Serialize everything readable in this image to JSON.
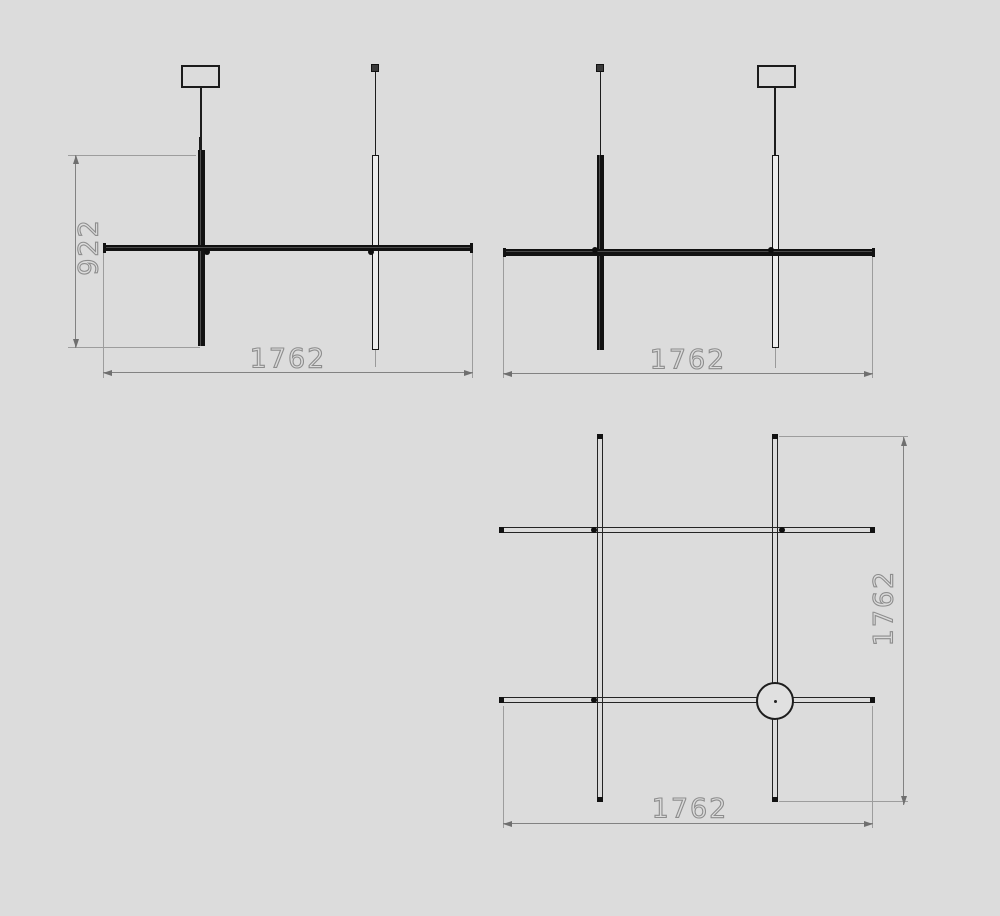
{
  "title": "pendant-lamp-dimension-drawing",
  "colors": {
    "background": "#dcdcdc",
    "fixture_line": "#1c1c1c",
    "dimension_line": "#828282",
    "dimension_text": "#8d8d8d"
  },
  "views": {
    "front_a": {
      "name": "front view A",
      "height_label": "922",
      "width_label": "1762"
    },
    "front_b": {
      "name": "front view B",
      "width_label": "1762"
    },
    "plan": {
      "name": "plan view",
      "width_label": "1762",
      "height_label": "1762"
    }
  }
}
